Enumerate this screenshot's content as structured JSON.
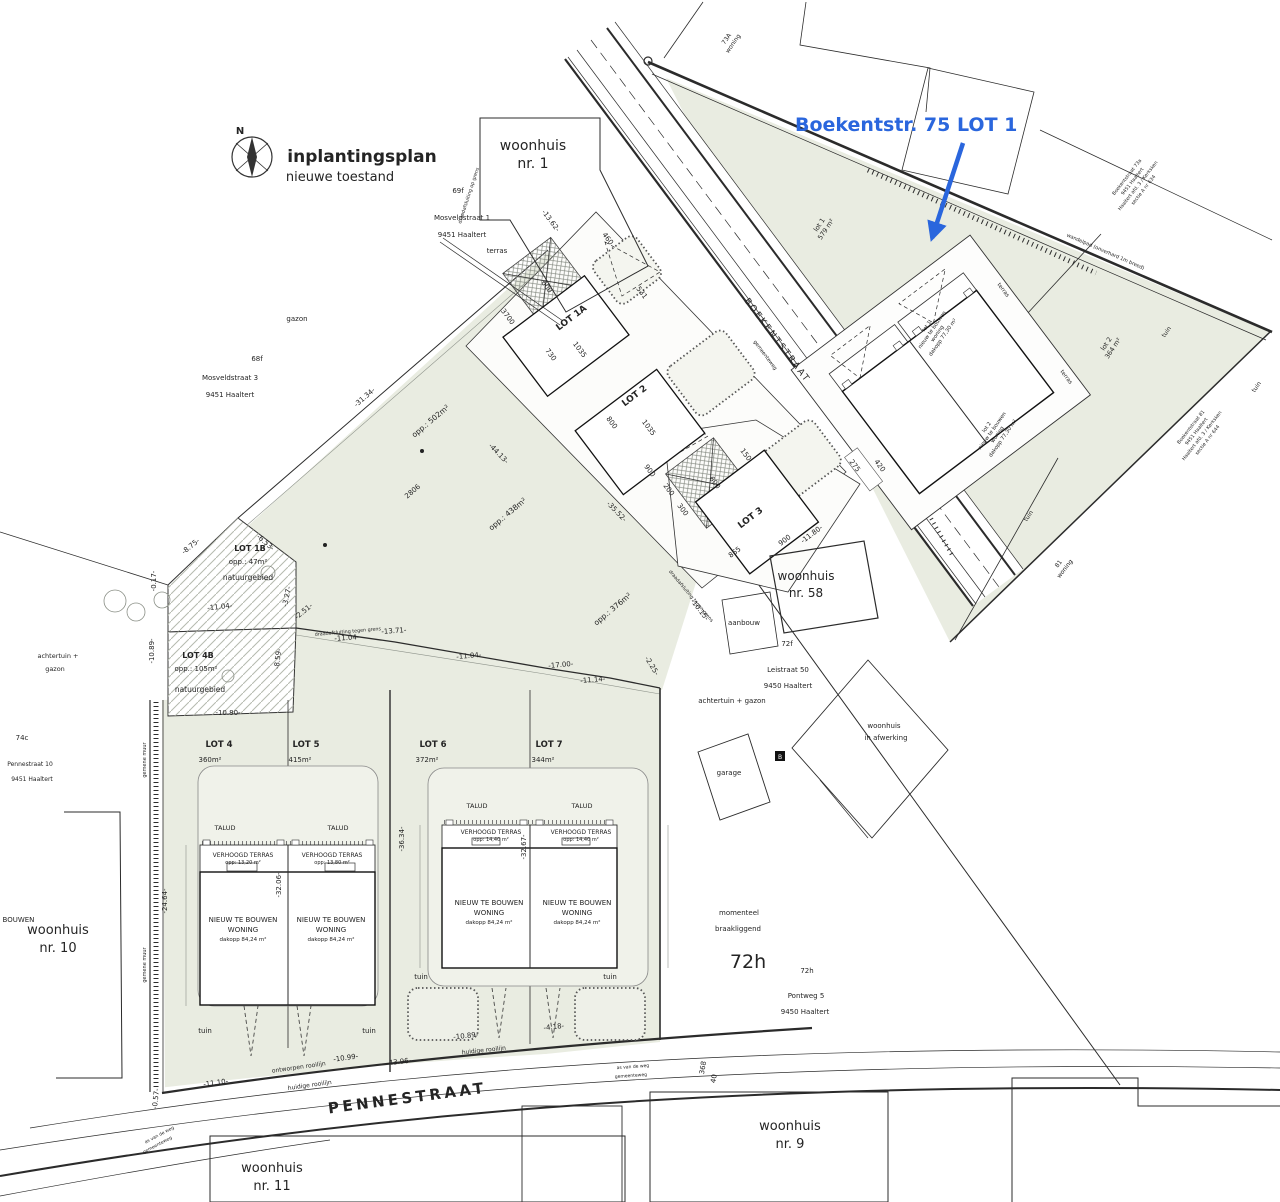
{
  "meta": {
    "title": "inplantingsplan",
    "subtitle": "nieuwe toestand",
    "north": "N"
  },
  "annotation": {
    "label": "Boekentstr. 75 LOT 1",
    "color": "#2a66dd"
  },
  "streets": {
    "boekentstraat": "BOEKENTSTRAAT",
    "pennestraat": "PENNESTRAAT",
    "gemeenteweg": "gemeenteweg",
    "as_van_de_weg": "as van de weg",
    "huidige_rooilijn": "huidige rooilijn",
    "ontworpen_rooilijn": "ontworpen rooilijn",
    "wandelpad": "wandelpad (onverhard 1m breed)"
  },
  "lots": {
    "lot1a": "LOT 1A",
    "lot2": "LOT 2",
    "lot3": "LOT 3",
    "lot4": {
      "label": "LOT 4",
      "area": "360m²"
    },
    "lot5": {
      "label": "LOT 5",
      "area": "415m²"
    },
    "lot6": {
      "label": "LOT 6",
      "area": "372m²"
    },
    "lot7": {
      "label": "LOT 7",
      "area": "344m²"
    },
    "lot1b": {
      "label": "LOT 1B",
      "area": "opp.: 47m²",
      "zone": "natuurgebied"
    },
    "lot4b": {
      "label": "LOT 4B",
      "area": "opp.: 105m²",
      "zone": "natuurgebied"
    },
    "lot1_site": {
      "name": "lot 1",
      "area": "579 m²"
    },
    "lot2_site": {
      "name": "lot 2",
      "area": "364 m²"
    },
    "opp1": "opp.: 502m²",
    "opp2": "opp.: 438m²",
    "opp3": "opp.: 376m²"
  },
  "buildings": {
    "new_house": {
      "l1": "NIEUW TE BOUWEN",
      "l2": "WONING",
      "roof": "dakopp 84,24 m²"
    },
    "terras": {
      "title": "VERHOOGD TERRAS",
      "opp4": "opp: 13,20 m²",
      "opp5": "opp: 13,80 m²",
      "opp67": "opp: 14,40 m²"
    },
    "talud": "TALUD",
    "unit1": {
      "l1": "lot 1",
      "l2": "nieuw te bouwen",
      "l3": "woning",
      "l4": "dakopp 77,30 m²"
    },
    "unit2": {
      "l1": "lot 2",
      "l2": "nieuw te bouwen",
      "l3": "woning",
      "l4": "dakopp 77,30 m²"
    },
    "terras_small": "terras"
  },
  "neighbors": {
    "wh1": {
      "l1": "woonhuis",
      "l2": "nr. 1"
    },
    "wh9": {
      "l1": "woonhuis",
      "l2": "nr. 9"
    },
    "wh10": {
      "l1": "woonhuis",
      "l2": "nr. 10"
    },
    "wh11": {
      "l1": "woonhuis",
      "l2": "nr. 11"
    },
    "wh58": {
      "l1": "woonhuis",
      "l2": "nr. 58"
    },
    "w73a": {
      "l1": "73A",
      "l2": "woning"
    },
    "w81": {
      "l1": "81",
      "l2": "woning"
    },
    "afw": {
      "l1": "woonhuis",
      "l2": "in afwerking"
    },
    "garage": "garage",
    "aanbouw": "aanbouw",
    "mos1": {
      "l1": "Mosveldstraat 1",
      "l2": "9451 Haaltert"
    },
    "mos3": {
      "l1": "Mosveldstraat 3",
      "l2": "9451 Haaltert"
    },
    "lei": {
      "l1": "Leistraat 50",
      "l2": "9450 Haaltert"
    },
    "pont": {
      "l1": "Pontweg 5",
      "l2": "9450 Haaltert"
    },
    "pen10": {
      "l1": "Pennestraat 10",
      "l2": "9451 Haaltert"
    },
    "addr73a": {
      "l1": "Boekentstraat 73a",
      "l2": "9451 Haaltert",
      "l3": "Haaltert afd. 3 / Kerksken",
      "l4": "sectie A nr 634"
    },
    "addr81": {
      "l1": "Boekentstraat 81",
      "l2": "9451 Haaltert",
      "l3": "Haaltert afd. 3 / Kerksken",
      "l4": "sectie A nr 644"
    },
    "status": {
      "l1": "momenteel",
      "l2": "braakliggend"
    },
    "k69f": "69f",
    "k68f": "68f",
    "k72f": "72f",
    "k72h": "72h",
    "k72hs": "72h",
    "k74c": "74c",
    "kB": "B"
  },
  "misc": {
    "tuin": "tuin",
    "gazon": "gazon",
    "terras": "terras",
    "achtertuin": "achtertuin + gazon",
    "achtertuin_l1": "achtertuin +",
    "achtertuin_l2": "gazon",
    "fence": "draadafsluiting tegen grens",
    "fence2": "draadafsluiting op grens",
    "wall": "gemene muur"
  },
  "dims": [
    "-13.62-",
    "460",
    "600",
    "3700",
    "730",
    "1035",
    "531",
    "800",
    "1035",
    "900",
    "200",
    "300",
    "150",
    "600",
    "865",
    "900",
    "-11.80-",
    "275",
    "420",
    "-31.34-",
    "2806",
    "-44.13-",
    "-35.52-",
    "-8.75-",
    "-6.53-",
    "-0.17-",
    "-11.04-",
    "-13.71-",
    "-11.04-",
    "-11.04-",
    "-17.00-",
    "-11.14-",
    "-3.27-",
    "-2.51-",
    "-8.59-",
    "-10.89-",
    "-10.80-",
    "-10.15-",
    "-2.25-",
    "-32.06-",
    "-36.34-",
    "-32.67-",
    "-24.64-",
    "-11.10-",
    "-10.99-",
    "-43.96-",
    "-10.89-",
    "-4.18-",
    "-0.57-",
    "368",
    "40"
  ]
}
